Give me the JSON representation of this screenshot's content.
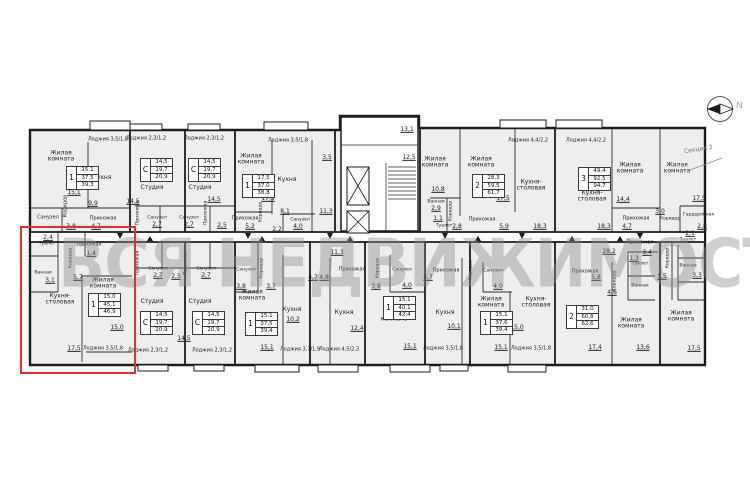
{
  "watermark": "ВСЯ НЕДВИЖИМОСТЬ",
  "compass": {
    "label": "N"
  },
  "section_label": "Секция 2",
  "colors": {
    "highlight": "#e03030",
    "wall": "#1c1c1c",
    "apartment_fill": "#eeeeee",
    "watermark": "#8f8f8f"
  },
  "tables": [
    {
      "x": 66,
      "y": 166,
      "rooms": "1",
      "values": [
        "15,1",
        "37,5",
        "39,3"
      ]
    },
    {
      "x": 140,
      "y": 158,
      "rooms": "С",
      "values": [
        "14,5",
        "19,7",
        "20,9"
      ]
    },
    {
      "x": 188,
      "y": 158,
      "rooms": "С",
      "values": [
        "14,5",
        "19,7",
        "20,9"
      ]
    },
    {
      "x": 242,
      "y": 174,
      "rooms": "1",
      "values": [
        "17,5",
        "37,0",
        "38,8"
      ]
    },
    {
      "x": 472,
      "y": 174,
      "rooms": "2",
      "values": [
        "28,3",
        "59,5",
        "61,7"
      ]
    },
    {
      "x": 578,
      "y": 167,
      "rooms": "3",
      "values": [
        "49,4",
        "92,5",
        "94,7"
      ]
    },
    {
      "x": 88,
      "y": 293,
      "rooms": "1",
      "values": [
        "15,0",
        "45,1",
        "46,9"
      ]
    },
    {
      "x": 140,
      "y": 311,
      "rooms": "С",
      "values": [
        "14,5",
        "19,7",
        "20,9"
      ]
    },
    {
      "x": 192,
      "y": 311,
      "rooms": "С",
      "values": [
        "14,5",
        "19,7",
        "20,9"
      ]
    },
    {
      "x": 245,
      "y": 312,
      "rooms": "1",
      "values": [
        "15,1",
        "37,5",
        "39,4"
      ]
    },
    {
      "x": 383,
      "y": 296,
      "rooms": "1",
      "values": [
        "15,1",
        "40,1",
        "42,4"
      ]
    },
    {
      "x": 480,
      "y": 311,
      "rooms": "1",
      "values": [
        "15,1",
        "37,6",
        "39,4"
      ]
    },
    {
      "x": 566,
      "y": 305,
      "rooms": "2",
      "values": [
        "31,0",
        "60,8",
        "62,6"
      ]
    }
  ],
  "labels": [
    {
      "t": "Жилая комната",
      "x": 61,
      "y": 157,
      "w": 34
    },
    {
      "t": "15,1",
      "x": 74,
      "y": 193,
      "u": 1
    },
    {
      "t": "Кухня",
      "x": 102,
      "y": 178
    },
    {
      "t": "9,9",
      "x": 93,
      "y": 204,
      "u": 1
    },
    {
      "t": "Санузел",
      "x": 48,
      "y": 218,
      "s": 5
    },
    {
      "t": "Коридор",
      "x": 66,
      "y": 206,
      "rot": -90,
      "s": 5
    },
    {
      "t": "Прихожая",
      "x": 103,
      "y": 219,
      "s": 5
    },
    {
      "t": "3,8",
      "x": 71,
      "y": 227,
      "u": 1
    },
    {
      "t": "4,7",
      "x": 96,
      "y": 227,
      "u": 1
    },
    {
      "t": "Лоджия 3,5/1,8",
      "x": 108,
      "y": 140,
      "s": 5
    },
    {
      "t": "Лоджия 2,3/1,2",
      "x": 146,
      "y": 139,
      "s": 5
    },
    {
      "t": "Лоджия 2,3/1,2",
      "x": 204,
      "y": 139,
      "s": 5
    },
    {
      "t": "Студия",
      "x": 152,
      "y": 188
    },
    {
      "t": "Студия",
      "x": 200,
      "y": 188
    },
    {
      "t": "14,5",
      "x": 133,
      "y": 202,
      "u": 1
    },
    {
      "t": "14,5",
      "x": 214,
      "y": 200,
      "u": 1
    },
    {
      "t": "Санузел",
      "x": 157,
      "y": 219,
      "s": 4.5
    },
    {
      "t": "2,7",
      "x": 157,
      "y": 225,
      "u": 1
    },
    {
      "t": "Санузел",
      "x": 189,
      "y": 219,
      "s": 4.5
    },
    {
      "t": "2,7",
      "x": 189,
      "y": 225,
      "u": 1
    },
    {
      "t": "Прихожая",
      "x": 139,
      "y": 213,
      "rot": -90,
      "s": 4.5
    },
    {
      "t": "Прихожая",
      "x": 207,
      "y": 213,
      "rot": -90,
      "s": 4.5
    },
    {
      "t": "2,5",
      "x": 222,
      "y": 226,
      "u": 1
    },
    {
      "t": "Жилая комната",
      "x": 251,
      "y": 160,
      "w": 34
    },
    {
      "t": "17,5",
      "x": 268,
      "y": 199,
      "u": 1
    },
    {
      "t": "Кухня",
      "x": 287,
      "y": 180
    },
    {
      "t": "8,1",
      "x": 285,
      "y": 212,
      "u": 1
    },
    {
      "t": "Санузел",
      "x": 300,
      "y": 221,
      "s": 4.5
    },
    {
      "t": "4,0",
      "x": 298,
      "y": 227,
      "u": 1
    },
    {
      "t": "Коридор",
      "x": 262,
      "y": 212,
      "rot": -90,
      "s": 4.5
    },
    {
      "t": "2,2",
      "x": 277,
      "y": 230,
      "u": 1
    },
    {
      "t": "Прихожая",
      "x": 245,
      "y": 219,
      "s": 5
    },
    {
      "t": "5,2",
      "x": 250,
      "y": 227,
      "u": 1
    },
    {
      "t": "Лоджия 3,5/1,8",
      "x": 288,
      "y": 141,
      "s": 5
    },
    {
      "t": "11,3",
      "x": 326,
      "y": 212,
      "u": 1
    },
    {
      "t": "3,5",
      "x": 327,
      "y": 158,
      "u": 1
    },
    {
      "t": "13,1",
      "x": 407,
      "y": 130,
      "u": 1
    },
    {
      "t": "12,5",
      "x": 409,
      "y": 158,
      "u": 1
    },
    {
      "t": "Жилая комната",
      "x": 435,
      "y": 163,
      "w": 34
    },
    {
      "t": "10,8",
      "x": 438,
      "y": 190,
      "u": 1
    },
    {
      "t": "Жилая комната",
      "x": 481,
      "y": 163,
      "w": 34
    },
    {
      "t": "17,5",
      "x": 503,
      "y": 199,
      "u": 1
    },
    {
      "t": "Кухня-столовая",
      "x": 531,
      "y": 186,
      "w": 38
    },
    {
      "t": "18,3",
      "x": 540,
      "y": 227,
      "u": 1
    },
    {
      "t": "Лоджия 4,4/2,2",
      "x": 528,
      "y": 141,
      "s": 5
    },
    {
      "t": "Ванная",
      "x": 436,
      "y": 203,
      "s": 4.5
    },
    {
      "t": "2,9",
      "x": 436,
      "y": 209,
      "u": 1
    },
    {
      "t": "Коридор",
      "x": 452,
      "y": 211,
      "rot": -90,
      "s": 4.5
    },
    {
      "t": "1,1",
      "x": 438,
      "y": 219,
      "u": 1
    },
    {
      "t": "Туалет",
      "x": 444,
      "y": 227,
      "s": 4.5
    },
    {
      "t": "2,8",
      "x": 457,
      "y": 227,
      "u": 1
    },
    {
      "t": "Прихожая",
      "x": 482,
      "y": 220,
      "s": 5
    },
    {
      "t": "5,9",
      "x": 504,
      "y": 227,
      "u": 1
    },
    {
      "t": "Лоджия 4,4/2,2",
      "x": 586,
      "y": 141,
      "s": 5
    },
    {
      "t": "Кухня-столовая",
      "x": 592,
      "y": 197,
      "w": 38
    },
    {
      "t": "18,3",
      "x": 604,
      "y": 227,
      "u": 1
    },
    {
      "t": "Жилая комната",
      "x": 630,
      "y": 169,
      "w": 34
    },
    {
      "t": "14,4",
      "x": 623,
      "y": 200,
      "u": 1
    },
    {
      "t": "Жилая комната",
      "x": 677,
      "y": 169,
      "w": 34
    },
    {
      "t": "17,5",
      "x": 699,
      "y": 199,
      "u": 1
    },
    {
      "t": "Прихожая",
      "x": 636,
      "y": 219,
      "s": 5
    },
    {
      "t": "4,7",
      "x": 627,
      "y": 227,
      "u": 1
    },
    {
      "t": "Коридор",
      "x": 670,
      "y": 220,
      "s": 4.5
    },
    {
      "t": "3,0",
      "x": 660,
      "y": 212,
      "u": 1
    },
    {
      "t": "Гардеробная",
      "x": 694,
      "y": 216,
      "s": 4.5,
      "w": 22
    },
    {
      "t": "2,8",
      "x": 702,
      "y": 227,
      "u": 1
    },
    {
      "t": "Туалет",
      "x": 47,
      "y": 245,
      "s": 4.5
    },
    {
      "t": "2,4",
      "x": 48,
      "y": 238,
      "u": 1
    },
    {
      "t": "Ванная",
      "x": 43,
      "y": 274,
      "s": 4.5
    },
    {
      "t": "3,1",
      "x": 50,
      "y": 281,
      "u": 1
    },
    {
      "t": "Коридор",
      "x": 72,
      "y": 258,
      "rot": -90,
      "s": 4.5
    },
    {
      "t": "5,7",
      "x": 78,
      "y": 278,
      "u": 1
    },
    {
      "t": "Прихожая",
      "x": 88,
      "y": 246,
      "s": 4.5,
      "w": 22
    },
    {
      "t": "1,4",
      "x": 91,
      "y": 254,
      "u": 1
    },
    {
      "t": "Кухня-столовая",
      "x": 60,
      "y": 300,
      "w": 32
    },
    {
      "t": "17,5",
      "x": 74,
      "y": 349,
      "u": 1
    },
    {
      "t": "Жилая комната",
      "x": 103,
      "y": 284,
      "w": 34
    },
    {
      "t": "15,0",
      "x": 117,
      "y": 328,
      "u": 1
    },
    {
      "t": "Лоджия 3,5/1,8",
      "x": 103,
      "y": 349,
      "s": 5
    },
    {
      "t": "Прихожая",
      "x": 139,
      "y": 263,
      "rot": -90,
      "s": 4.5
    },
    {
      "t": "Санузел",
      "x": 158,
      "y": 270,
      "s": 4.5
    },
    {
      "t": "2,7",
      "x": 158,
      "y": 276,
      "u": 1
    },
    {
      "t": "2,5",
      "x": 176,
      "y": 277,
      "u": 1
    },
    {
      "t": "Прихожая",
      "x": 187,
      "y": 263,
      "rot": -90,
      "s": 4.5
    },
    {
      "t": "Санузел",
      "x": 206,
      "y": 270,
      "s": 4.5
    },
    {
      "t": "2,7",
      "x": 206,
      "y": 276,
      "u": 1
    },
    {
      "t": "Студия",
      "x": 152,
      "y": 302
    },
    {
      "t": "Студия",
      "x": 200,
      "y": 302
    },
    {
      "t": "14,5",
      "x": 184,
      "y": 339,
      "u": 1
    },
    {
      "t": "Лоджия 2,3/1,2",
      "x": 148,
      "y": 351,
      "s": 5
    },
    {
      "t": "Лоджия 2,3/1,2",
      "x": 212,
      "y": 351,
      "s": 5
    },
    {
      "t": "Санузел",
      "x": 246,
      "y": 271,
      "s": 4.5
    },
    {
      "t": "3,8",
      "x": 241,
      "y": 287,
      "u": 1
    },
    {
      "t": "Коридор",
      "x": 263,
      "y": 268,
      "rot": -90,
      "s": 4.5
    },
    {
      "t": "3,7",
      "x": 271,
      "y": 287,
      "u": 1
    },
    {
      "t": "Жилая комната",
      "x": 252,
      "y": 296,
      "w": 34
    },
    {
      "t": "15,1",
      "x": 267,
      "y": 348,
      "u": 1
    },
    {
      "t": "Кухня",
      "x": 292,
      "y": 310
    },
    {
      "t": "10,2",
      "x": 293,
      "y": 320,
      "u": 1
    },
    {
      "t": "Лоджия 3,7/1,9",
      "x": 300,
      "y": 350,
      "s": 5
    },
    {
      "t": "11,3",
      "x": 337,
      "y": 253,
      "u": 1
    },
    {
      "t": "Прихожая",
      "x": 352,
      "y": 270,
      "s": 5
    },
    {
      "t": "4,7",
      "x": 313,
      "y": 278,
      "u": 1
    },
    {
      "t": "4,8",
      "x": 324,
      "y": 278,
      "u": 1
    },
    {
      "t": "Кухня",
      "x": 344,
      "y": 313
    },
    {
      "t": "12,4",
      "x": 357,
      "y": 329,
      "u": 1
    },
    {
      "t": "Лоджия 4,5/2,3",
      "x": 339,
      "y": 350,
      "s": 5
    },
    {
      "t": "Коридор",
      "x": 379,
      "y": 268,
      "rot": -90,
      "s": 4.5
    },
    {
      "t": "Санузел",
      "x": 402,
      "y": 271,
      "s": 4.5
    },
    {
      "t": "4,0",
      "x": 407,
      "y": 286,
      "u": 1
    },
    {
      "t": "3,8",
      "x": 376,
      "y": 287,
      "u": 1
    },
    {
      "t": "Жилая комната",
      "x": 394,
      "y": 317,
      "w": 34
    },
    {
      "t": "15,1",
      "x": 410,
      "y": 347,
      "u": 1
    },
    {
      "t": "Лоджия 3,5/1,8",
      "x": 443,
      "y": 349,
      "s": 5
    },
    {
      "t": "Прихожая",
      "x": 446,
      "y": 271,
      "s": 5
    },
    {
      "t": "4,7",
      "x": 428,
      "y": 278,
      "u": 1
    },
    {
      "t": "Кухня",
      "x": 445,
      "y": 313
    },
    {
      "t": "10,1",
      "x": 454,
      "y": 327,
      "u": 1
    },
    {
      "t": "Коридор",
      "x": 472,
      "y": 270,
      "rot": -90,
      "s": 4.5
    },
    {
      "t": "Санузел",
      "x": 493,
      "y": 272,
      "s": 4.5
    },
    {
      "t": "4,0",
      "x": 498,
      "y": 287,
      "u": 1
    },
    {
      "t": "Жилая комната",
      "x": 491,
      "y": 303,
      "w": 34
    },
    {
      "t": "15,1",
      "x": 501,
      "y": 348,
      "u": 1
    },
    {
      "t": "Кухня-столовая",
      "x": 536,
      "y": 303,
      "w": 38
    },
    {
      "t": "15,0",
      "x": 517,
      "y": 328,
      "u": 1
    },
    {
      "t": "Лоджия 3,5/1,8",
      "x": 531,
      "y": 349,
      "s": 5
    },
    {
      "t": "Прихожая",
      "x": 585,
      "y": 272,
      "s": 5
    },
    {
      "t": "5,8",
      "x": 596,
      "y": 278,
      "u": 1
    },
    {
      "t": "Жилая комната",
      "x": 581,
      "y": 324,
      "w": 34
    },
    {
      "t": "17,4",
      "x": 595,
      "y": 348,
      "u": 1
    },
    {
      "t": "Коридор",
      "x": 616,
      "y": 281,
      "rot": -90,
      "s": 4.5
    },
    {
      "t": "4,6",
      "x": 612,
      "y": 293,
      "u": 1
    },
    {
      "t": "Жилая комната",
      "x": 631,
      "y": 324,
      "w": 34
    },
    {
      "t": "13,6",
      "x": 643,
      "y": 348,
      "u": 1
    },
    {
      "t": "Туалет",
      "x": 640,
      "y": 265,
      "s": 4.5
    },
    {
      "t": "1,3",
      "x": 634,
      "y": 259,
      "u": 1
    },
    {
      "t": "Ванная",
      "x": 640,
      "y": 287,
      "s": 4.5
    },
    {
      "t": "28,2",
      "x": 609,
      "y": 252,
      "u": 1
    },
    {
      "t": "Прихожая",
      "x": 640,
      "y": 243,
      "s": 5
    },
    {
      "t": "3,4",
      "x": 647,
      "y": 253,
      "u": 1
    },
    {
      "t": "Коридор",
      "x": 669,
      "y": 258,
      "rot": -90,
      "s": 4.5
    },
    {
      "t": "5,5",
      "x": 662,
      "y": 277,
      "u": 1
    },
    {
      "t": "Туалет",
      "x": 688,
      "y": 241,
      "s": 4.5
    },
    {
      "t": "2,1",
      "x": 690,
      "y": 234,
      "u": 1
    },
    {
      "t": "Ванная",
      "x": 688,
      "y": 267,
      "s": 4.5
    },
    {
      "t": "3,3",
      "x": 697,
      "y": 276,
      "u": 1
    },
    {
      "t": "Жилая комната",
      "x": 681,
      "y": 317,
      "w": 34
    },
    {
      "t": "17,5",
      "x": 694,
      "y": 349,
      "u": 1
    }
  ]
}
